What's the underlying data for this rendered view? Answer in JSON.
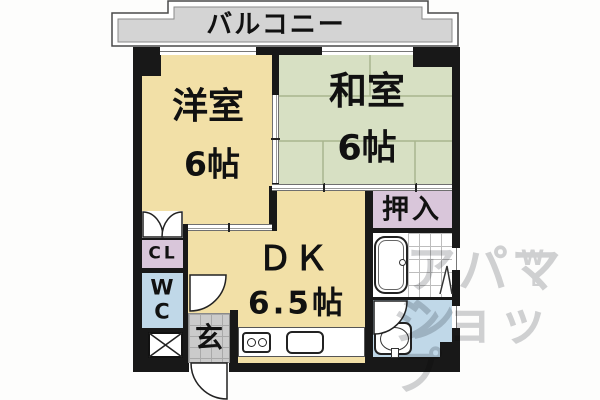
{
  "balcony": {
    "label": "バルコニー"
  },
  "rooms": {
    "western": {
      "name": "洋室",
      "size": "6帖"
    },
    "japanese": {
      "name": "和室",
      "size": "6帖"
    },
    "dining_kitchen": {
      "name": "ＤＫ",
      "size": "6.5帖"
    },
    "oshiire": {
      "name": "押入"
    },
    "closet": {
      "name": "CL"
    },
    "toilet": {
      "letter1": "W",
      "letter2": "C"
    },
    "entrance": {
      "name": "玄"
    }
  },
  "watermark": {
    "line1": "アパマン",
    "line2": "ショップ",
    "logo_letter1": "W",
    "logo_letter2": "L"
  },
  "colors": {
    "room-tan": "#f2e0a7",
    "room-green": "#d7e0c3",
    "room-lavender": "#d9c6da",
    "room-blue": "#c0d8e8",
    "genkan-gray": "#cbcbcb",
    "balcony-gray": "#d4d4d4",
    "wall-black": "#181818",
    "tatami-line": "#a9b58e",
    "watermark-gray": "#c9cacd"
  }
}
